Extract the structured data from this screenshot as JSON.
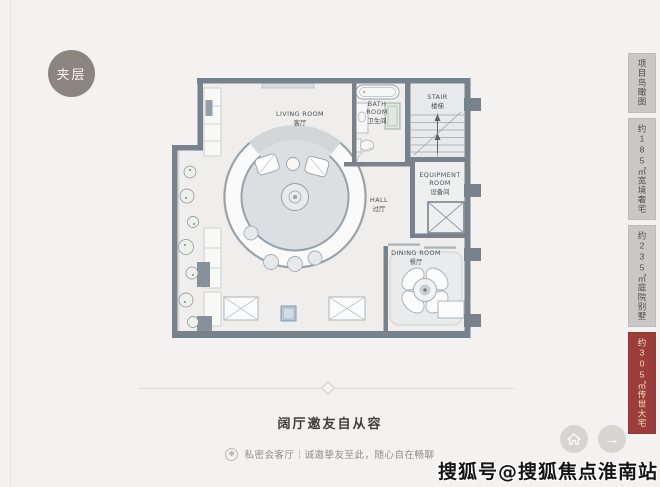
{
  "badge": {
    "label": "夹层"
  },
  "plan": {
    "rooms": [
      {
        "id": "living",
        "l1": "LIVING ROOM",
        "l2": "客厅"
      },
      {
        "id": "bath",
        "l1": "BATH",
        "l2": "ROOM",
        "l3": "卫生间"
      },
      {
        "id": "stair",
        "l1": "STAIR",
        "l2": "楼梯"
      },
      {
        "id": "equipment",
        "l1": "EQUIPMENT",
        "l2": "ROOM",
        "l3": "设备间"
      },
      {
        "id": "hall",
        "l1": "HALL",
        "l2": "过厅"
      },
      {
        "id": "dining",
        "l1": "DINING ROOM",
        "l2": "餐厅"
      }
    ]
  },
  "sidebar": {
    "items": [
      {
        "label": "项目鸟瞰图",
        "active": false
      },
      {
        "label": "约185㎡宽境奢宅",
        "active": false
      },
      {
        "label": "约235㎡庭院别墅",
        "active": false
      },
      {
        "label": "约305㎡传世大宅",
        "active": true
      }
    ]
  },
  "footer": {
    "heading": "阔厅邀友自从容",
    "caption": "私密会客厅｜诚邀挚友至此，随心自在畅聊",
    "seal_glyph": "✽",
    "next_arrow": "→"
  },
  "watermark": {
    "text": "搜狐号@搜狐焦点淮南站"
  },
  "colors": {
    "page_bg": "#f3f2f0",
    "wall": "#77828d",
    "badge_bg": "#8a857f",
    "tab_bg": "#c9c8c6",
    "tab_active_bg": "#9c3d3b",
    "tab_active_text": "#f0e2c0",
    "rug": "#d2d6d9"
  }
}
